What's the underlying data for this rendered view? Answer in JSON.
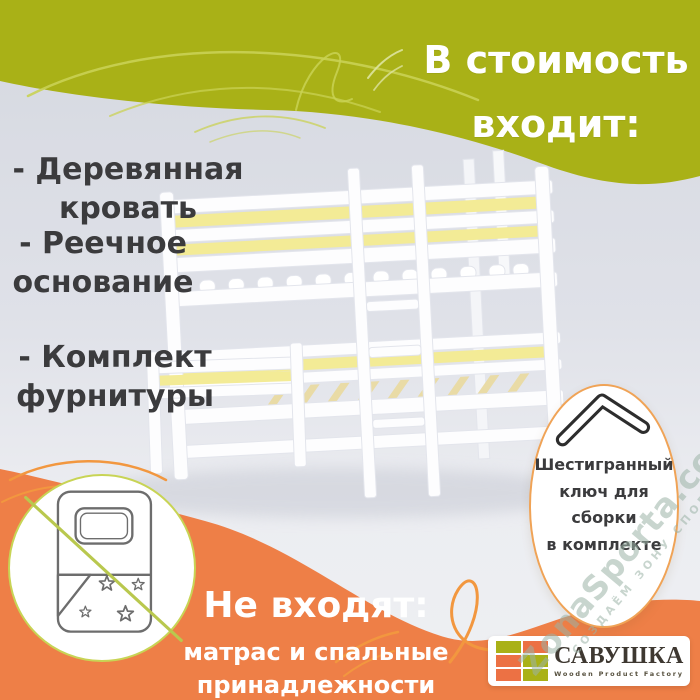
{
  "title": {
    "line1": "В стоимость",
    "line2": "входит:"
  },
  "included_items": [
    {
      "line1": "- Деревянная",
      "line2": "кровать"
    },
    {
      "line1": "- Реечное",
      "line2": "основание"
    },
    {
      "line1": "- Комплект",
      "line2": "фурнитуры"
    }
  ],
  "hex_key_badge": {
    "lines": [
      "Шестигранный",
      "ключ для",
      "сборки",
      "в комплекте"
    ]
  },
  "not_included": {
    "heading": "Не входят:",
    "line1": "матрас и спальные",
    "line2": "принадлежности"
  },
  "logo": {
    "name": "САВУШКА",
    "tagline": "Wooden Product Factory"
  },
  "watermark": {
    "main": "ZonaSporta.com",
    "sub": "СОЗДАЁМ ЗОНУ СПОРТА"
  },
  "icons": {
    "hex_key": "hex-key-icon",
    "bedding_crossed": "bedding-crossed-out-icon",
    "bed": "bunk-bed-illustration",
    "logo_tiles": "logo-tile-grid-icon",
    "swirls": "swirl-decoration"
  },
  "colors": {
    "olive": "#a9b117",
    "olive_swirl": "#c9d254",
    "orange": "#ee7f47",
    "orange_swirl": "#f2973f",
    "bed_accent_yellow": "#f3eb96",
    "slat_wood": "#e9dba6",
    "text_dark": "#3b3b3d",
    "text_white": "#ffffff",
    "badge_border_orange": "#f0a356",
    "badge_border_green": "#c8d455",
    "background_gray": "#dfe1e8"
  }
}
